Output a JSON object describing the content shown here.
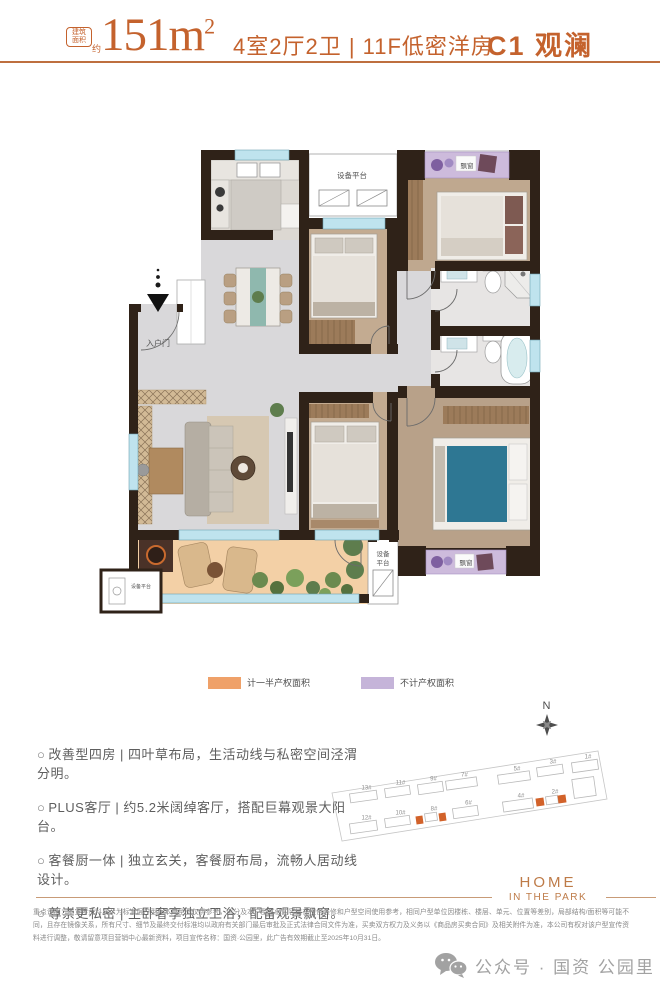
{
  "header": {
    "badge": {
      "line1": "建筑",
      "line2": "面积",
      "suffix": "约"
    },
    "area_value": "151m",
    "area_sup": "2",
    "specs": "4室2厅2卫 | 11F低密洋房",
    "unit_name": "C1 观澜",
    "accent_color": "#C4622D"
  },
  "floor_plan": {
    "labels": {
      "equipment_top": "设备平台",
      "entry": "入户门",
      "bay_top": "飘窗",
      "bay_bottom": "飘窗",
      "equipment_right_1": "设备",
      "equipment_right_2": "平台",
      "equipment_corner": "设备平台"
    }
  },
  "legend": {
    "items": [
      {
        "label": "计一半产权面积",
        "color": "#EFA169"
      },
      {
        "label": "不计产权面积",
        "color": "#C5B4D9"
      }
    ]
  },
  "features_marker": "○",
  "features": [
    "改善型四房 | 四叶草布局，生活动线与私密空间泾渭分明。",
    "PLUS客厅 | 约5.2米阔绰客厅，搭配巨幕观景大阳台。",
    "客餐厨一体 | 独立玄关，客餐厨布局，流畅人居动线设计。",
    "尊崇更私密 | 主卧奢享独立卫浴，配备观景飘窗。"
  ],
  "site_plan": {
    "compass": "N",
    "highlight_color": "#D2622A",
    "buildings": [
      {
        "label": "13#",
        "x": 20,
        "y": 57,
        "w": 27,
        "h": 9
      },
      {
        "label": "11#",
        "x": 55,
        "y": 52,
        "w": 25,
        "h": 9
      },
      {
        "label": "9#",
        "x": 88,
        "y": 48,
        "w": 25,
        "h": 10
      },
      {
        "label": "7#",
        "x": 116,
        "y": 44,
        "w": 31,
        "h": 9
      },
      {
        "label": "5#",
        "x": 168,
        "y": 38,
        "w": 32,
        "h": 9
      },
      {
        "label": "3#",
        "x": 207,
        "y": 31,
        "w": 26,
        "h": 9
      },
      {
        "label": "1#",
        "x": 242,
        "y": 26,
        "w": 26,
        "h": 10
      },
      {
        "label": "",
        "x": 243,
        "y": 43,
        "w": 22,
        "h": 19
      },
      {
        "label": "12#",
        "x": 20,
        "y": 87,
        "w": 27,
        "h": 10
      },
      {
        "label": "10#",
        "x": 55,
        "y": 82,
        "w": 25,
        "h": 9
      },
      {
        "label": "8#",
        "x": 95,
        "y": 78,
        "w": 12,
        "h": 8
      },
      {
        "label": "6#",
        "x": 123,
        "y": 72,
        "w": 25,
        "h": 10
      },
      {
        "label": "4#",
        "x": 173,
        "y": 65,
        "w": 30,
        "h": 10
      },
      {
        "label": "2#",
        "x": 216,
        "y": 61,
        "w": 12,
        "h": 8
      }
    ],
    "highlights": [
      {
        "x": 86,
        "y": 81,
        "w": 7,
        "h": 8
      },
      {
        "x": 109,
        "y": 78,
        "w": 7,
        "h": 8
      },
      {
        "x": 206,
        "y": 63,
        "w": 8,
        "h": 8
      },
      {
        "x": 228,
        "y": 60,
        "w": 8,
        "h": 8
      }
    ]
  },
  "brand": {
    "line1": "HOME",
    "line2": "IN THE PARK"
  },
  "disclaimer": "重点说明：本宣传资料展示为标准层户型，本户型图仅供参考，部分及本户型其他内容旨在提供装修和户型空间使用参考，相同户型单位因楼栋、楼层、单元、位置等差别，局部结构/面积等可能不同，且存在镜像关系，所有尺寸、细节及最终交付标准均以政府有关部门最后审批及正式法律合同文件为准，买卖双方权力及义务以《商品房买卖合同》及相关附件为准，本公司有权对该户型宣传资料进行调整，敬请留意项目营销中心最新资料，项目宣传名称：国资·公园里，此广告有效期截止至2025年10月31日。",
  "footer": {
    "wechat_label": "公众号 · 国资 公园里"
  }
}
